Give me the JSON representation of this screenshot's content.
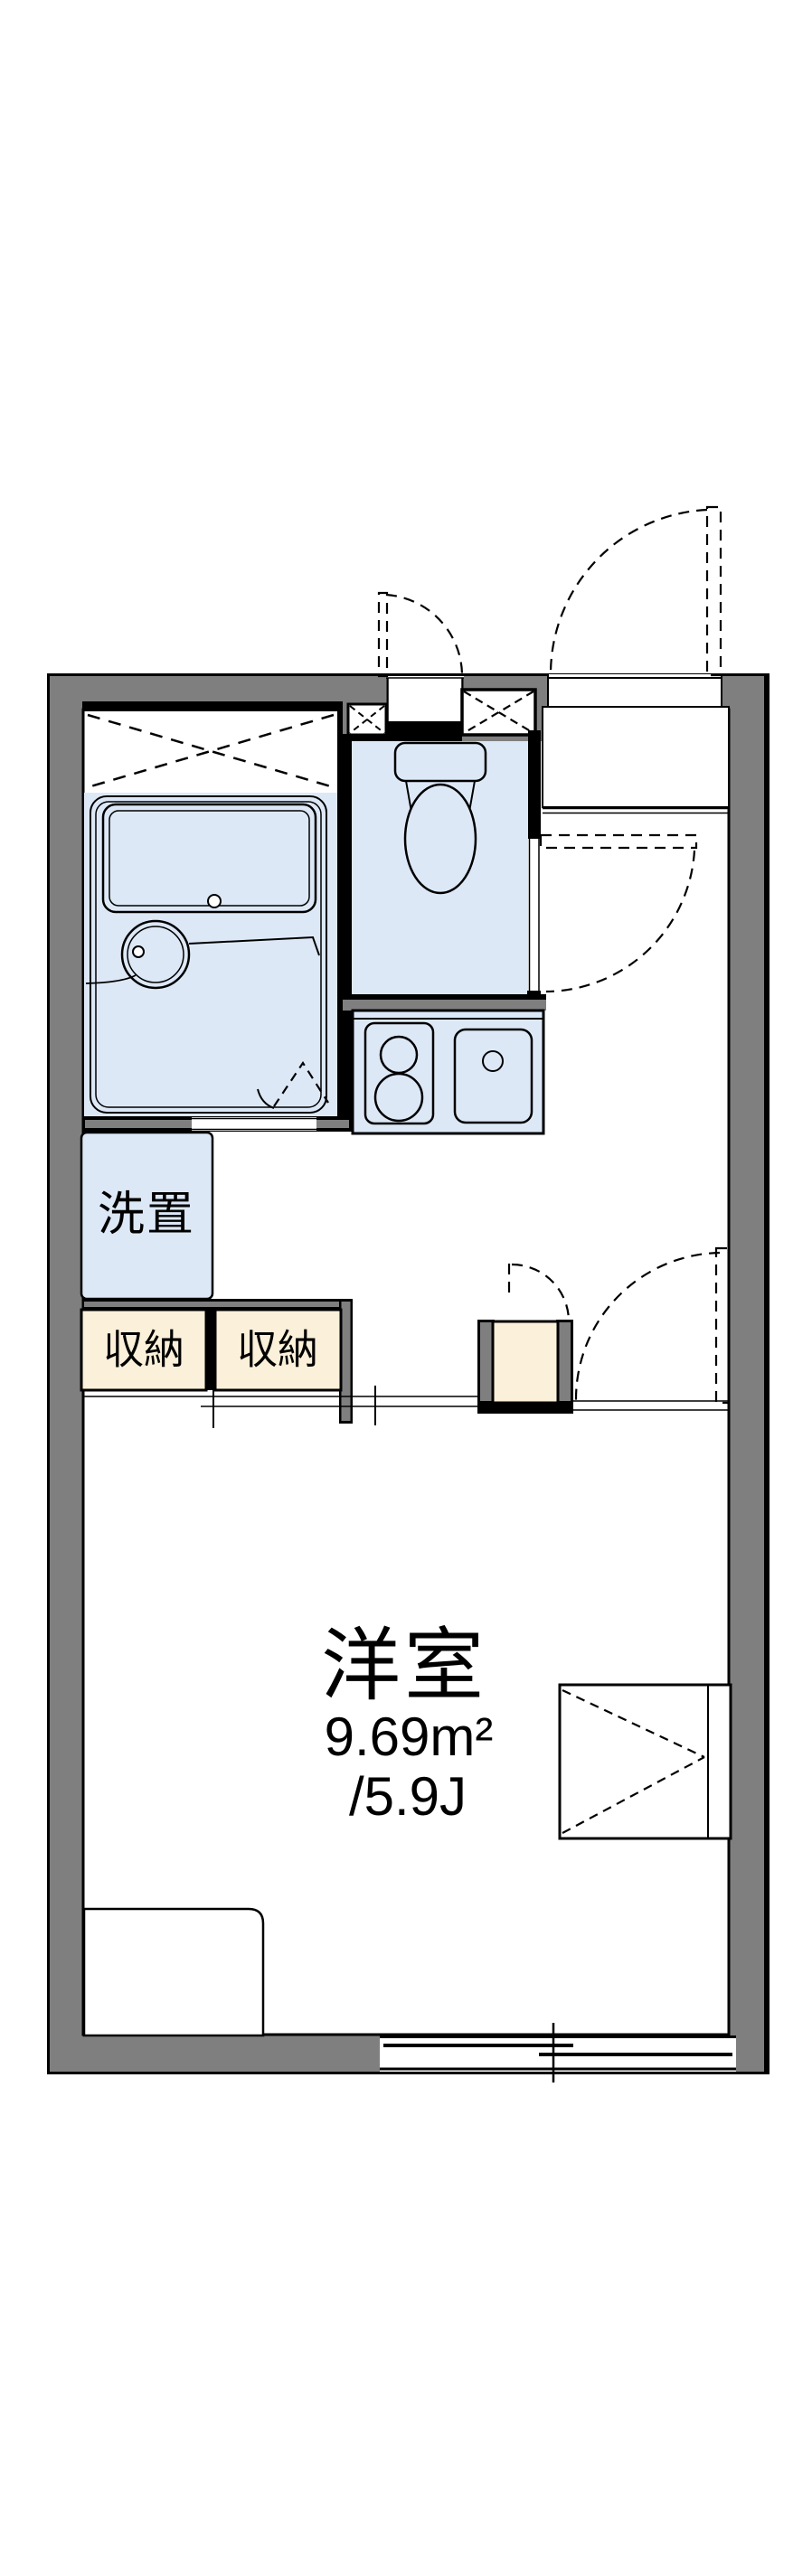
{
  "plan": {
    "room": {
      "label": "洋室",
      "area_m2": "9.69m²",
      "area_tatami": "/5.9J"
    },
    "washer": {
      "label": "洗置"
    },
    "storage_left": {
      "label": "収納"
    },
    "storage_right": {
      "label": "収納"
    }
  },
  "colors": {
    "wall_gray": "#7f7f7f",
    "water_blue": "#dde8f7",
    "storage_cream": "#fbf0d9",
    "line_black": "#000000"
  },
  "fixtures": [
    "bathtub",
    "wash-basin",
    "toilet",
    "kitchen-stove",
    "kitchen-sink",
    "washing-machine-space",
    "storage-closet",
    "shoe-cabinet",
    "bed",
    "bay-window",
    "sliding-window",
    "entrance-door",
    "bath-folding-door",
    "pipe-space",
    "genkan-step"
  ]
}
